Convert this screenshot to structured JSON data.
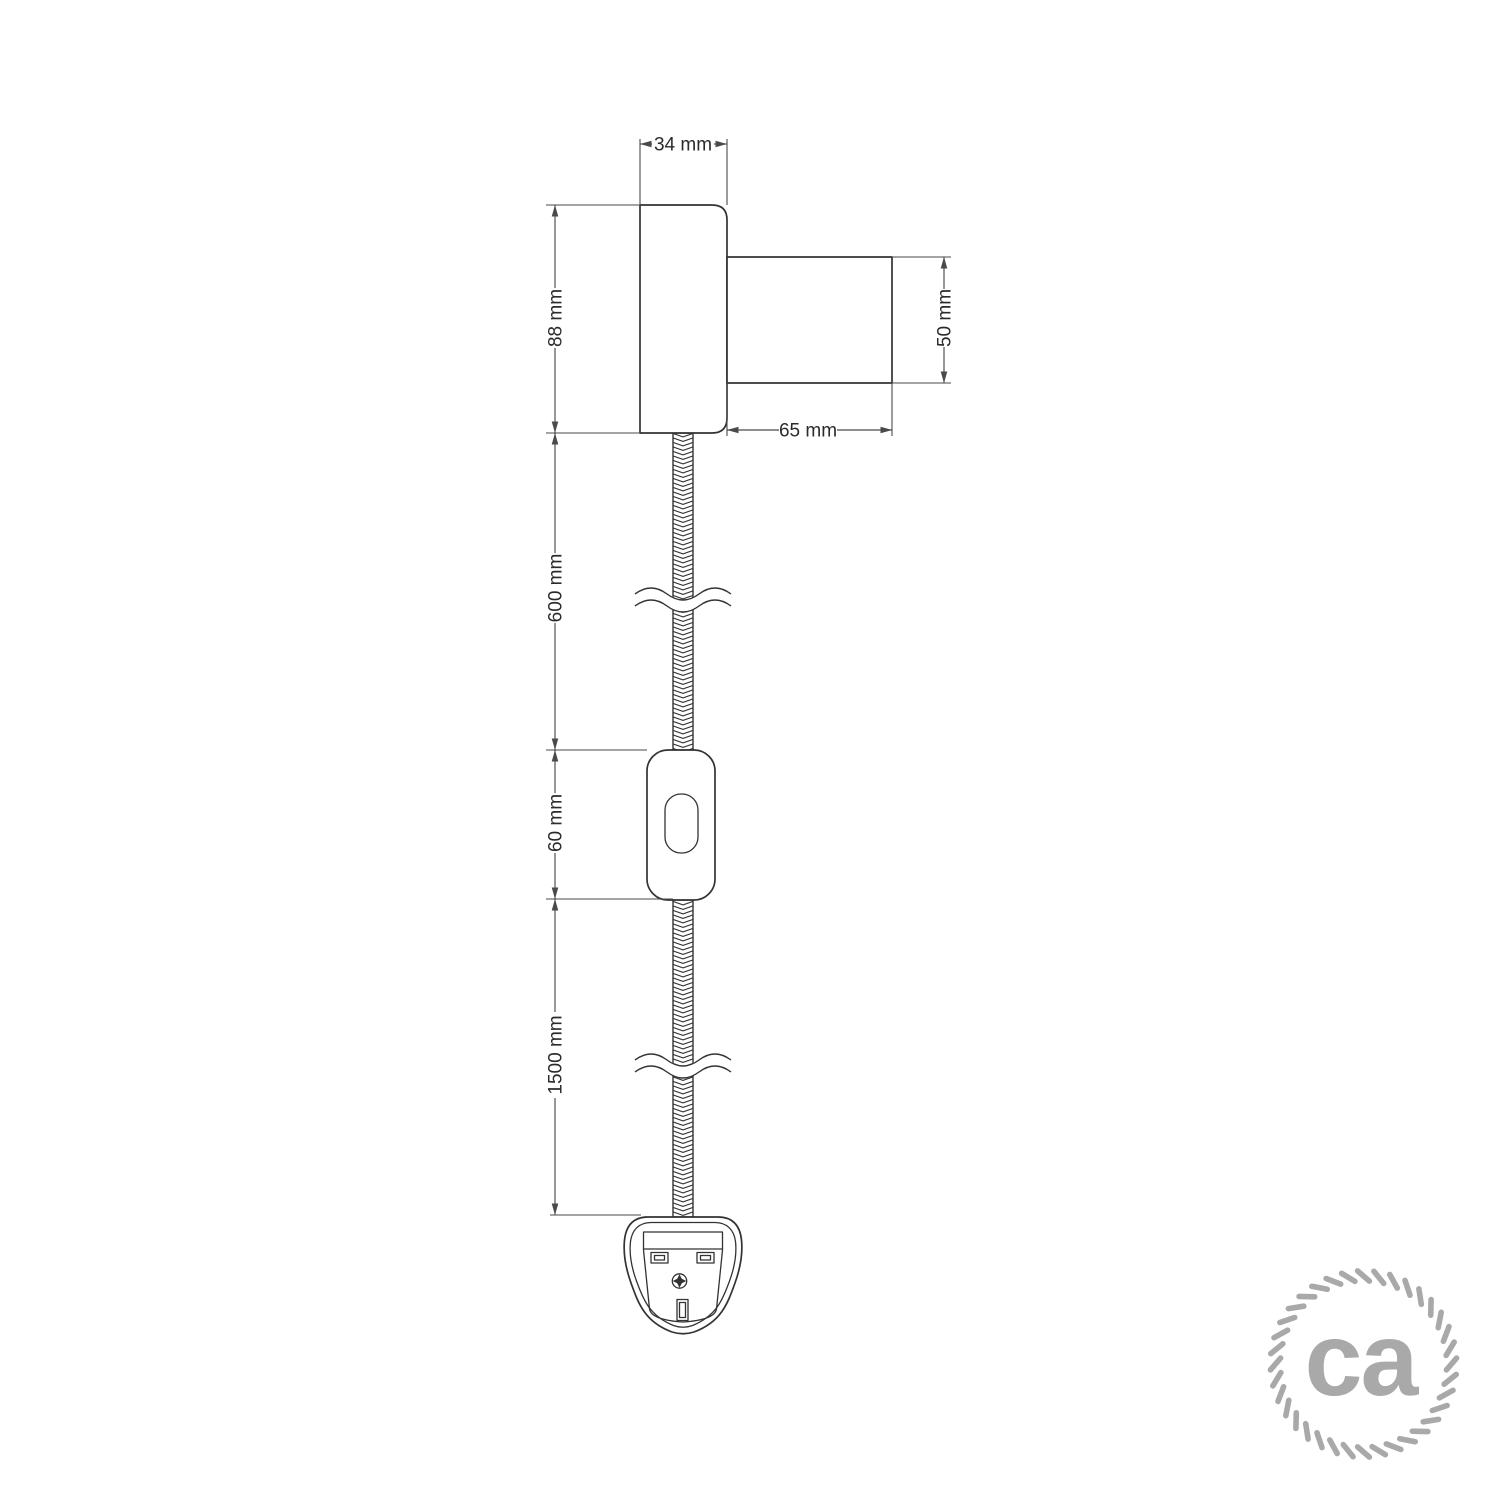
{
  "colors": {
    "background": "#ffffff",
    "outline": "#333333",
    "dimension": "#4a4a4a",
    "text": "#2b2b2b",
    "logo": "#a9a9a9"
  },
  "dimensions": {
    "body_width": "34 mm",
    "body_height": "88 mm",
    "socket_diameter": "50 mm",
    "socket_length": "65 mm",
    "upper_cable": "600 mm",
    "switch_body": "60 mm",
    "lower_cable": "1500 mm"
  },
  "logo": {
    "text": "ca"
  }
}
